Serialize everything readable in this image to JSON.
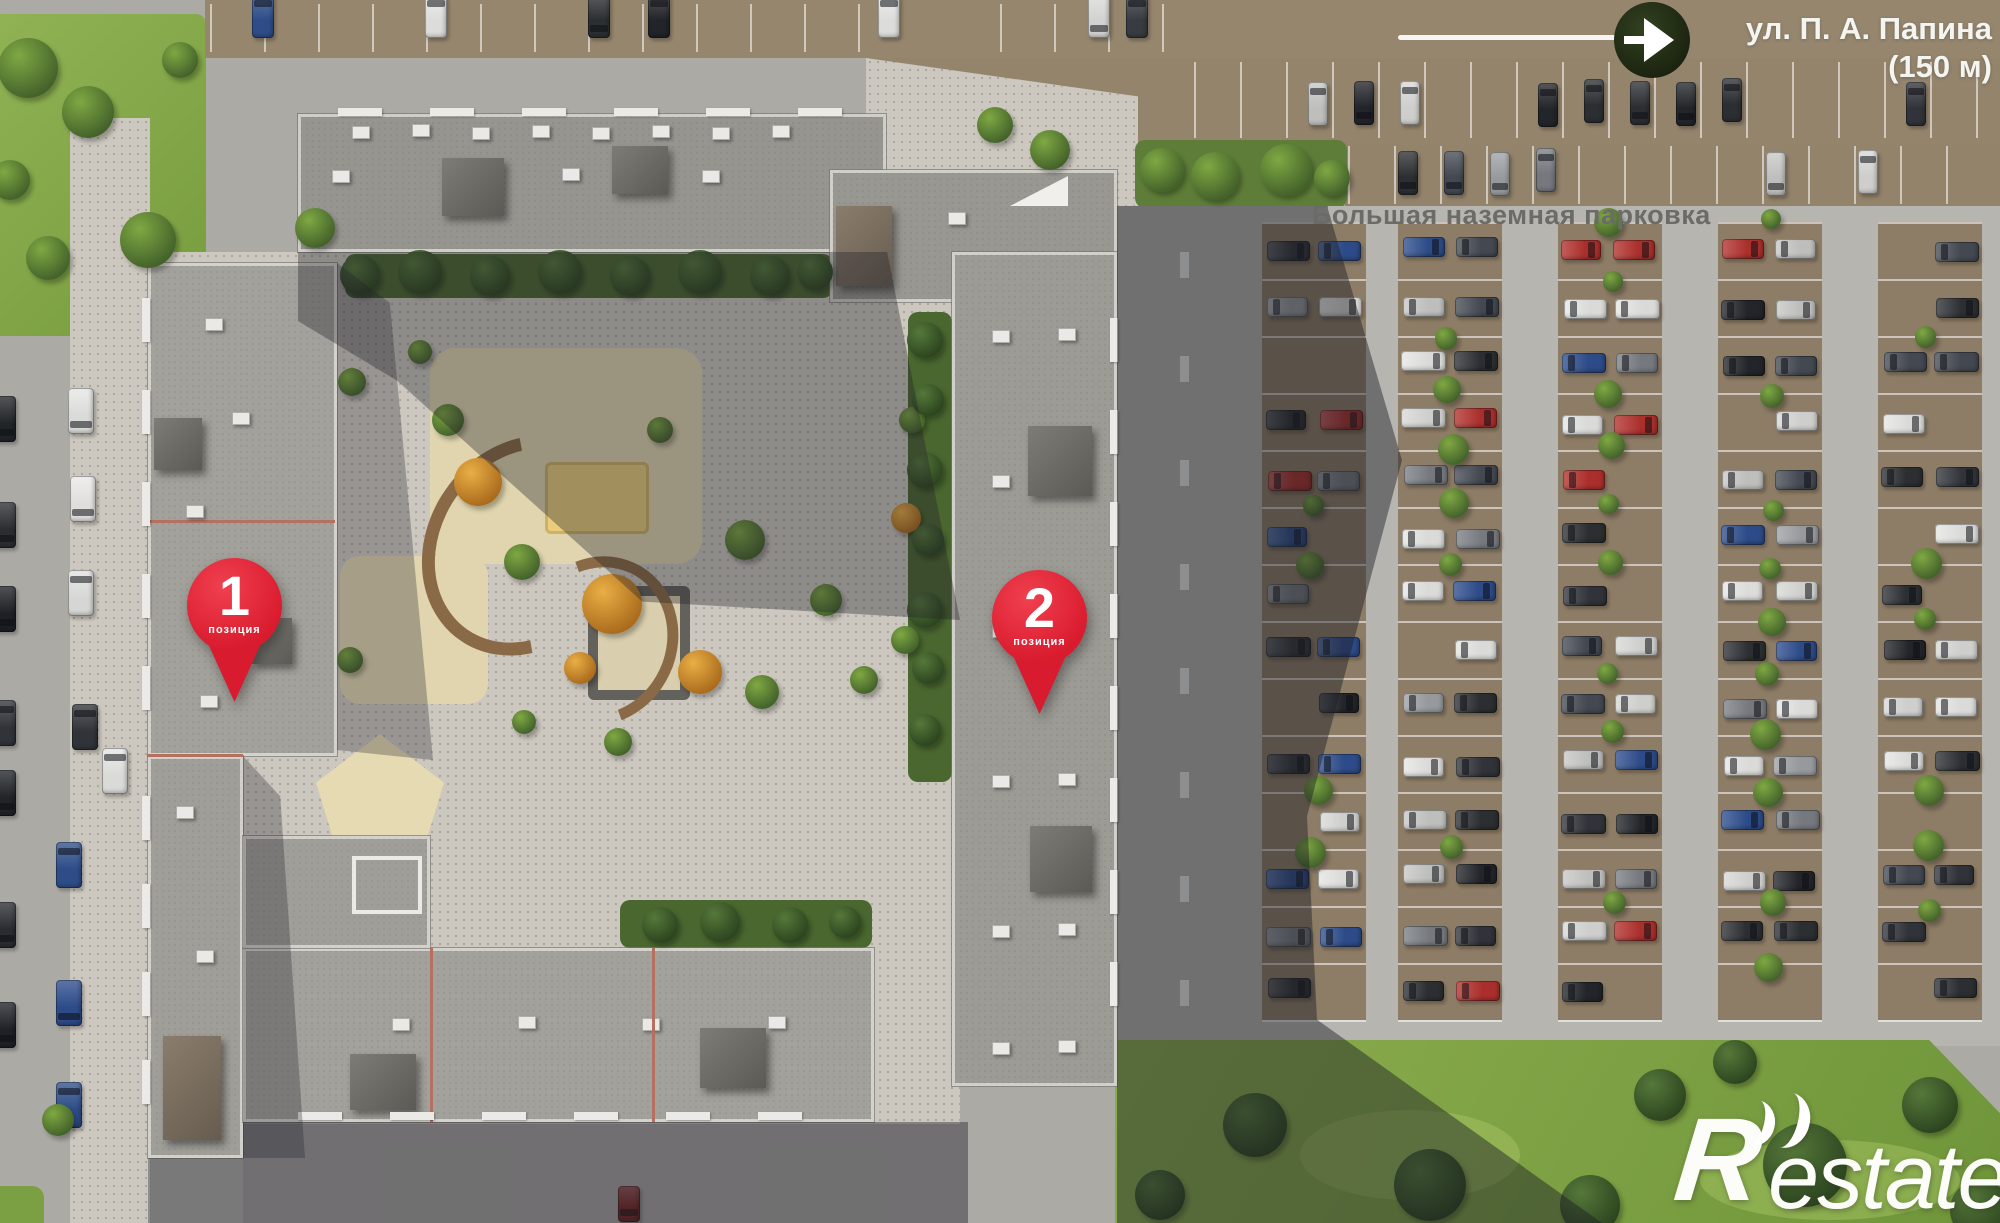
{
  "map": {
    "street_label": {
      "line1": "ул. П. А. Папина",
      "line2": "(150 м)"
    },
    "parking_label": "Большая наземная парковка",
    "markers": [
      {
        "number": "1",
        "caption": "позиция"
      },
      {
        "number": "2",
        "caption": "позиция"
      }
    ],
    "watermark": {
      "prefix": "R",
      "suffix": "estate"
    },
    "colors": {
      "pin_red": "#d81b2e",
      "label_gray": "#6b6b67",
      "street_text": "#f4f4f1",
      "arrow_circle": "#222c15"
    }
  },
  "scene": {
    "palette": {
      "stall_brown": "#8e7d66",
      "car_colors": [
        "#24272b",
        "#e6e6e4",
        "#9fa2a5",
        "#474c55",
        "#b3322e",
        "#2f4f8f",
        "#7b7f85",
        "#d9d9d7",
        "#2e3134",
        "#e8e8e6",
        "#33363c",
        "#c8c8c6"
      ]
    },
    "parking": {
      "columns_x": [
        1262,
        1398,
        1558,
        1718,
        1878
      ],
      "col_w": 104,
      "rows": 14,
      "row_pitch": 57,
      "row_start": 222,
      "fill": 0.8
    },
    "car_rows": [
      {
        "x0": 1216,
        "x1": 1972,
        "step": 46,
        "y": 80,
        "h": 44,
        "w": 20,
        "p": 0.78
      },
      {
        "x0": 1352,
        "x1": 1988,
        "step": 46,
        "y": 150,
        "h": 44,
        "w": 20,
        "p": 0.5
      }
    ],
    "line_rows": [
      {
        "x0": 1194,
        "x1": 1990,
        "step": 46,
        "y": 62,
        "h": 76
      },
      {
        "x0": 1348,
        "x1": 1990,
        "step": 46,
        "y": 146,
        "h": 58
      },
      {
        "x0": 210,
        "x1": 866,
        "step": 54,
        "y": 4,
        "h": 48
      },
      {
        "x0": 1000,
        "x1": 1180,
        "step": 54,
        "y": 4,
        "h": 48
      }
    ],
    "top_cars": [
      {
        "x": 252,
        "c": "#30518f"
      },
      {
        "x": 425,
        "c": "#e8e8e6"
      },
      {
        "x": 588,
        "c": "#2e3134"
      },
      {
        "x": 648,
        "c": "#23262a"
      },
      {
        "x": 878,
        "c": "#e8e8e6"
      },
      {
        "x": 1088,
        "c": "#dddddb"
      },
      {
        "x": 1126,
        "c": "#3a3f46"
      }
    ],
    "left_road_cars": [
      {
        "x": 68,
        "y": 388,
        "c": "#e6e6e4"
      },
      {
        "x": 70,
        "y": 476,
        "c": "#eceae8"
      },
      {
        "x": 68,
        "y": 570,
        "c": "#e2e2e0"
      },
      {
        "x": 72,
        "y": 704,
        "c": "#33363b"
      },
      {
        "x": 56,
        "y": 842,
        "c": "#30518f"
      },
      {
        "x": 56,
        "y": 980,
        "c": "#2f4f8f"
      },
      {
        "x": 56,
        "y": 1082,
        "c": "#30518f"
      },
      {
        "x": 102,
        "y": 748,
        "c": "#e6e6e4"
      }
    ],
    "edge_cars": [
      {
        "y": 396,
        "c": "#23262a"
      },
      {
        "y": 502,
        "c": "#2d3034"
      },
      {
        "y": 586,
        "c": "#1f2226"
      },
      {
        "y": 700,
        "c": "#33363c"
      },
      {
        "y": 770,
        "c": "#23262a"
      },
      {
        "y": 902,
        "c": "#2b2e33"
      },
      {
        "y": 1002,
        "c": "#202328"
      }
    ],
    "bottom_car": {
      "x": 618,
      "y": 1186,
      "c": "#7e2a28"
    },
    "road_dashes": {
      "x": 1180,
      "y0": 252,
      "y1": 1010,
      "step": 104,
      "w": 9,
      "h": 26
    },
    "roof_units": [
      {
        "t": "ac",
        "x": 352,
        "y": 126
      },
      {
        "t": "ac",
        "x": 412,
        "y": 124
      },
      {
        "t": "ac",
        "x": 472,
        "y": 127
      },
      {
        "t": "ac",
        "x": 532,
        "y": 125
      },
      {
        "t": "ac",
        "x": 592,
        "y": 127
      },
      {
        "t": "ac",
        "x": 652,
        "y": 125
      },
      {
        "t": "ac",
        "x": 712,
        "y": 127
      },
      {
        "t": "ac",
        "x": 772,
        "y": 125
      },
      {
        "t": "ac",
        "x": 332,
        "y": 170
      },
      {
        "t": "ac",
        "x": 562,
        "y": 168
      },
      {
        "t": "ac",
        "x": 702,
        "y": 170
      },
      {
        "t": "dark",
        "x": 442,
        "y": 158,
        "w": 62,
        "h": 58
      },
      {
        "t": "dark",
        "x": 612,
        "y": 146,
        "w": 56,
        "h": 48
      },
      {
        "t": "brown",
        "x": 836,
        "y": 206,
        "w": 56,
        "h": 80
      },
      {
        "t": "tri",
        "x": 1010,
        "y": 176,
        "w": 58,
        "h": 30
      },
      {
        "t": "ac",
        "x": 948,
        "y": 212
      },
      {
        "t": "ac",
        "x": 992,
        "y": 330
      },
      {
        "t": "ac",
        "x": 1058,
        "y": 328
      },
      {
        "t": "ac",
        "x": 992,
        "y": 475
      },
      {
        "t": "ac",
        "x": 1058,
        "y": 473
      },
      {
        "t": "ac",
        "x": 992,
        "y": 625
      },
      {
        "t": "ac",
        "x": 1058,
        "y": 623
      },
      {
        "t": "ac",
        "x": 992,
        "y": 775
      },
      {
        "t": "ac",
        "x": 1058,
        "y": 773
      },
      {
        "t": "ac",
        "x": 992,
        "y": 925
      },
      {
        "t": "ac",
        "x": 1058,
        "y": 923
      },
      {
        "t": "ac",
        "x": 992,
        "y": 1042
      },
      {
        "t": "ac",
        "x": 1058,
        "y": 1040
      },
      {
        "t": "dark",
        "x": 1028,
        "y": 426,
        "w": 64,
        "h": 70
      },
      {
        "t": "dark",
        "x": 1030,
        "y": 826,
        "w": 62,
        "h": 66
      },
      {
        "t": "ac",
        "x": 205,
        "y": 318
      },
      {
        "t": "ac",
        "x": 232,
        "y": 412
      },
      {
        "t": "ac",
        "x": 186,
        "y": 505
      },
      {
        "t": "ac",
        "x": 218,
        "y": 602
      },
      {
        "t": "ac",
        "x": 200,
        "y": 695
      },
      {
        "t": "dark",
        "x": 154,
        "y": 418,
        "w": 48,
        "h": 52
      },
      {
        "t": "dark",
        "x": 252,
        "y": 618,
        "w": 40,
        "h": 46
      },
      {
        "t": "ac",
        "x": 196,
        "y": 950
      },
      {
        "t": "ac",
        "x": 176,
        "y": 806
      },
      {
        "t": "brown",
        "x": 163,
        "y": 1036,
        "w": 58,
        "h": 104
      },
      {
        "t": "ac",
        "x": 392,
        "y": 1018
      },
      {
        "t": "ac",
        "x": 518,
        "y": 1016
      },
      {
        "t": "ac",
        "x": 642,
        "y": 1018
      },
      {
        "t": "ac",
        "x": 768,
        "y": 1016
      },
      {
        "t": "dark",
        "x": 350,
        "y": 1054,
        "w": 66,
        "h": 56
      },
      {
        "t": "dark",
        "x": 700,
        "y": 1028,
        "w": 66,
        "h": 60
      },
      {
        "t": "wf",
        "x": 352,
        "y": 856,
        "w": 62,
        "h": 50
      },
      {
        "t": "red",
        "x": 430,
        "y": 948,
        "w": 3,
        "h": 174
      },
      {
        "t": "red",
        "x": 652,
        "y": 948,
        "w": 3,
        "h": 174
      }
    ],
    "balcony_rows": [
      {
        "o": "v",
        "x": 142,
        "y0": 298,
        "n": 5,
        "step": 92
      },
      {
        "o": "v",
        "x": 142,
        "y0": 796,
        "n": 4,
        "step": 88
      },
      {
        "o": "v",
        "x": 1110,
        "y0": 318,
        "n": 8,
        "step": 92
      },
      {
        "o": "h",
        "y": 1112,
        "x0": 298,
        "n": 6,
        "step": 92
      },
      {
        "o": "h",
        "y": 108,
        "x0": 338,
        "n": 6,
        "step": 92
      }
    ],
    "courtyard_trees": [
      {
        "x": 478,
        "y": 482,
        "r": 24,
        "c": "o"
      },
      {
        "x": 612,
        "y": 604,
        "r": 30,
        "c": "o"
      },
      {
        "x": 700,
        "y": 672,
        "r": 22,
        "c": "o"
      },
      {
        "x": 580,
        "y": 668,
        "r": 16,
        "c": "o"
      },
      {
        "x": 906,
        "y": 518,
        "r": 15,
        "c": "o"
      },
      {
        "x": 448,
        "y": 420,
        "r": 16,
        "c": "g"
      },
      {
        "x": 522,
        "y": 562,
        "r": 18,
        "c": "g"
      },
      {
        "x": 660,
        "y": 430,
        "r": 13,
        "c": "g"
      },
      {
        "x": 745,
        "y": 540,
        "r": 20,
        "c": "g"
      },
      {
        "x": 826,
        "y": 600,
        "r": 16,
        "c": "g"
      },
      {
        "x": 864,
        "y": 680,
        "r": 14,
        "c": "g"
      },
      {
        "x": 762,
        "y": 692,
        "r": 17,
        "c": "g"
      },
      {
        "x": 618,
        "y": 742,
        "r": 14,
        "c": "g"
      },
      {
        "x": 524,
        "y": 722,
        "r": 12,
        "c": "g"
      },
      {
        "x": 352,
        "y": 382,
        "r": 14,
        "c": "g"
      },
      {
        "x": 350,
        "y": 660,
        "r": 13,
        "c": "g"
      },
      {
        "x": 58,
        "y": 1120,
        "r": 16,
        "c": "g"
      },
      {
        "x": 420,
        "y": 352,
        "r": 12,
        "c": "g"
      },
      {
        "x": 905,
        "y": 640,
        "r": 14,
        "c": "g"
      },
      {
        "x": 912,
        "y": 420,
        "r": 13,
        "c": "g"
      },
      {
        "x": 315,
        "y": 228,
        "r": 20,
        "c": "g"
      },
      {
        "x": 360,
        "y": 275,
        "r": 20,
        "c": "d"
      },
      {
        "x": 420,
        "y": 272,
        "r": 22,
        "c": "d"
      },
      {
        "x": 490,
        "y": 276,
        "r": 20,
        "c": "d"
      },
      {
        "x": 560,
        "y": 272,
        "r": 22,
        "c": "d"
      },
      {
        "x": 630,
        "y": 276,
        "r": 20,
        "c": "d"
      },
      {
        "x": 700,
        "y": 272,
        "r": 22,
        "c": "d"
      },
      {
        "x": 770,
        "y": 276,
        "r": 20,
        "c": "d"
      },
      {
        "x": 815,
        "y": 272,
        "r": 18,
        "c": "d"
      },
      {
        "x": 925,
        "y": 340,
        "r": 18,
        "c": "d"
      },
      {
        "x": 928,
        "y": 400,
        "r": 16,
        "c": "d"
      },
      {
        "x": 925,
        "y": 470,
        "r": 18,
        "c": "d"
      },
      {
        "x": 928,
        "y": 540,
        "r": 16,
        "c": "d"
      },
      {
        "x": 925,
        "y": 610,
        "r": 18,
        "c": "d"
      },
      {
        "x": 928,
        "y": 668,
        "r": 16,
        "c": "d"
      },
      {
        "x": 925,
        "y": 730,
        "r": 16,
        "c": "d"
      },
      {
        "x": 660,
        "y": 925,
        "r": 18,
        "c": "d"
      },
      {
        "x": 720,
        "y": 922,
        "r": 20,
        "c": "d"
      },
      {
        "x": 790,
        "y": 925,
        "r": 18,
        "c": "d"
      },
      {
        "x": 845,
        "y": 922,
        "r": 16,
        "c": "d"
      }
    ],
    "grass_tl_trees": [
      {
        "x": 28,
        "y": 68,
        "r": 30
      },
      {
        "x": 88,
        "y": 112,
        "r": 26
      },
      {
        "x": 48,
        "y": 258,
        "r": 22
      },
      {
        "x": 148,
        "y": 240,
        "r": 28
      },
      {
        "x": 10,
        "y": 180,
        "r": 20
      },
      {
        "x": 180,
        "y": 60,
        "r": 18
      }
    ],
    "lawn_br_trees": [
      {
        "x": 1255,
        "y": 1125,
        "r": 32
      },
      {
        "x": 1430,
        "y": 1185,
        "r": 36
      },
      {
        "x": 1660,
        "y": 1095,
        "r": 26
      },
      {
        "x": 1805,
        "y": 1165,
        "r": 42
      },
      {
        "x": 1590,
        "y": 1205,
        "r": 30
      },
      {
        "x": 1930,
        "y": 1105,
        "r": 28
      },
      {
        "x": 1735,
        "y": 1062,
        "r": 22
      },
      {
        "x": 1160,
        "y": 1195,
        "r": 25
      },
      {
        "x": 1980,
        "y": 1210,
        "r": 30
      }
    ],
    "top_bushes": [
      {
        "x": 1162,
        "y": 170,
        "r": 22
      },
      {
        "x": 1215,
        "y": 176,
        "r": 24
      },
      {
        "x": 1286,
        "y": 170,
        "r": 26
      },
      {
        "x": 1332,
        "y": 178,
        "r": 18
      },
      {
        "x": 1050,
        "y": 150,
        "r": 20
      },
      {
        "x": 995,
        "y": 125,
        "r": 18
      }
    ]
  }
}
